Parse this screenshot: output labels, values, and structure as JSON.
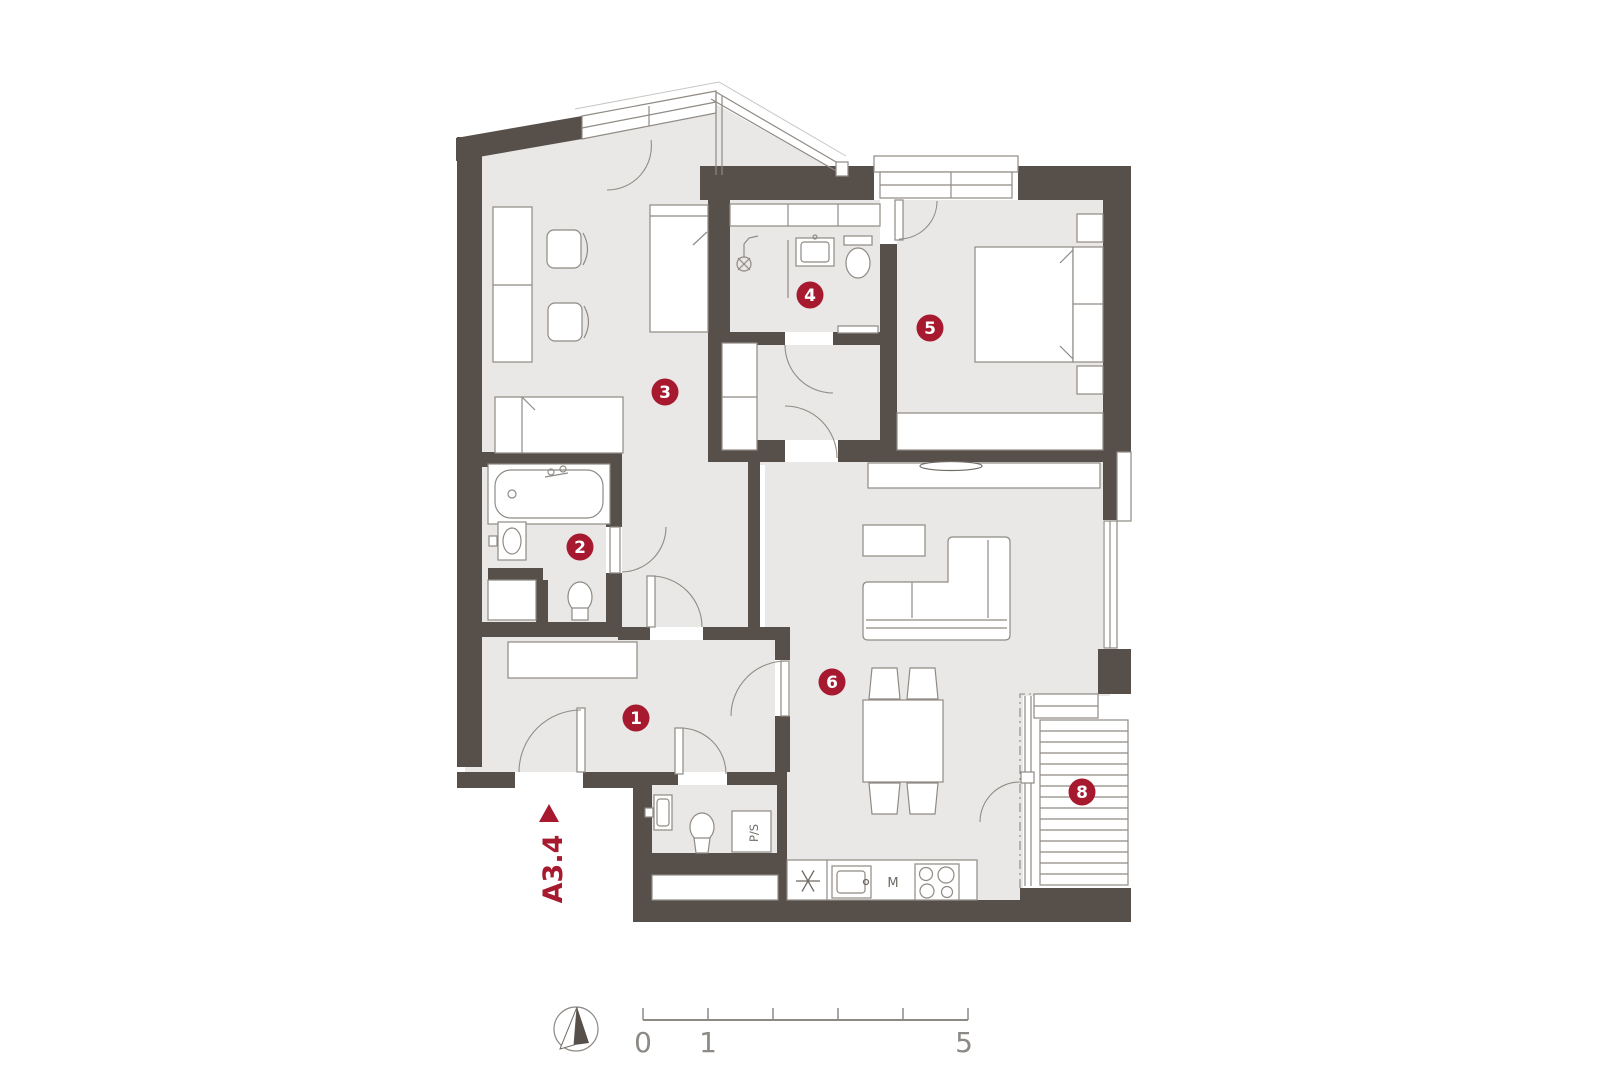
{
  "plan": {
    "unit": {
      "label": "A3.4"
    },
    "room_badges": [
      {
        "number": "1"
      },
      {
        "number": "2"
      },
      {
        "number": "3"
      },
      {
        "number": "4"
      },
      {
        "number": "5"
      },
      {
        "number": "6"
      },
      {
        "number": "8"
      }
    ],
    "appliance_labels": {
      "dishwasher": "M",
      "washer_dryer": "P/S"
    },
    "scale_bar": {
      "tick_labels": [
        "0",
        "1",
        "5"
      ]
    },
    "colors": {
      "wall": "#57504a",
      "floor": "#e9e8e6",
      "accent_red": "#a6192e",
      "line": "#8f8a84",
      "text_gray": "#8d8a85"
    }
  }
}
